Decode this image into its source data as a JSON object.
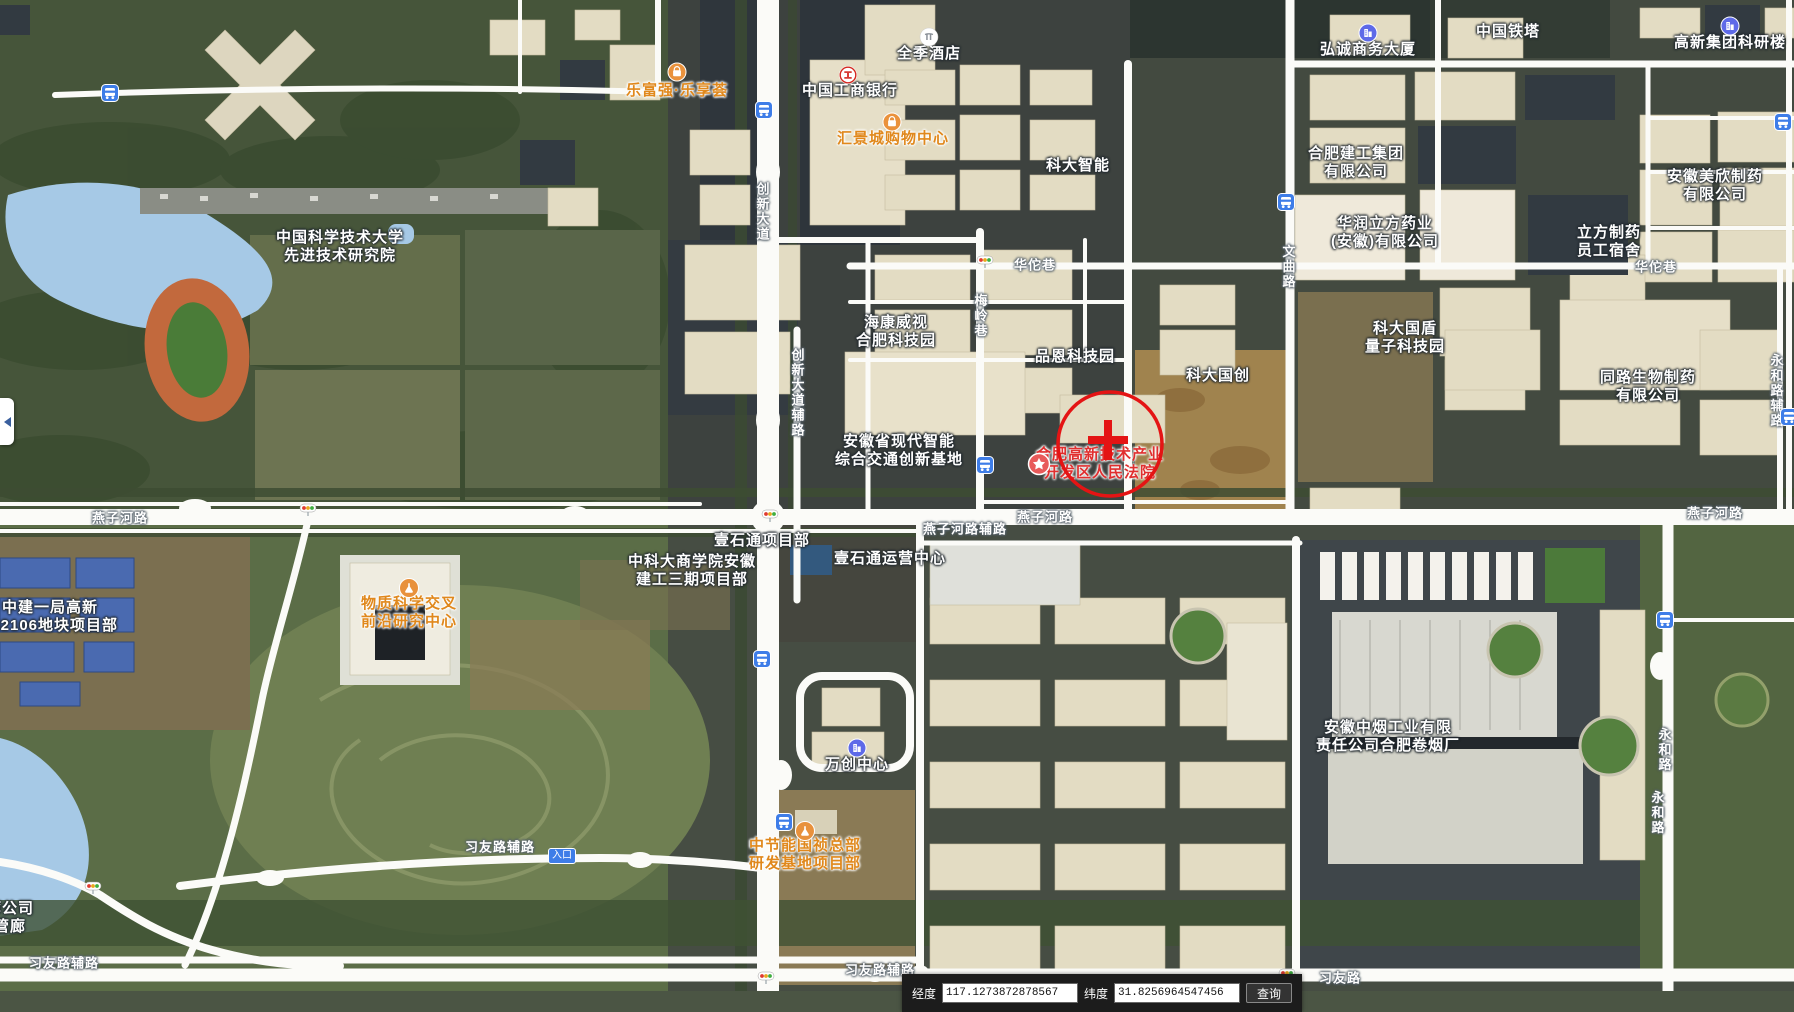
{
  "colors": {
    "accent_blue": "#3e7de8",
    "poi_orange": "#e0881c",
    "poi_red": "#e02f2f",
    "annotation_red": "#e41414",
    "road_white": "#fbfbf8",
    "water": "#a6c9e6"
  },
  "map": {
    "poi_labels": [
      {
        "name": "ustc-advanced-tech-institute",
        "lines": [
          "中国科学技术大学",
          "先进技术研究院"
        ],
        "x": 340,
        "y": 247,
        "color": "white"
      },
      {
        "name": "lefuqiang-lexianghui",
        "lines": [
          "乐富强·乐享荟"
        ],
        "x": 677,
        "y": 91,
        "color": "orange",
        "icon": "shopping-bag",
        "icon_pos": [
          677,
          72
        ]
      },
      {
        "name": "quanji-hotel",
        "lines": [
          "全季酒店"
        ],
        "x": 929,
        "y": 54,
        "color": "white",
        "icon": "hotel",
        "icon_pos": [
          929,
          37
        ]
      },
      {
        "name": "icbc-bank",
        "lines": [
          "中国工商银行"
        ],
        "x": 850,
        "y": 91,
        "color": "white",
        "icon": "bank",
        "icon_pos": [
          848,
          75
        ]
      },
      {
        "name": "huijingcheng-mall",
        "lines": [
          "汇景城购物中心"
        ],
        "x": 893,
        "y": 139,
        "color": "orange",
        "icon": "shopping-bag",
        "icon_pos": [
          892,
          122
        ]
      },
      {
        "name": "keda-intelligent",
        "lines": [
          "科大智能"
        ],
        "x": 1078,
        "y": 166,
        "color": "white"
      },
      {
        "name": "hikvision-hefei-tech-park",
        "lines": [
          "海康威视",
          "合肥科技园"
        ],
        "x": 896,
        "y": 332,
        "color": "white"
      },
      {
        "name": "pinen-tech-park",
        "lines": [
          "品恩科技园"
        ],
        "x": 1075,
        "y": 357,
        "color": "white"
      },
      {
        "name": "keda-guochuang",
        "lines": [
          "科大国创"
        ],
        "x": 1218,
        "y": 376,
        "color": "white"
      },
      {
        "name": "anhui-intelligent-transport-base",
        "lines": [
          "安徽省现代智能",
          "综合交通创新基地"
        ],
        "x": 899,
        "y": 451,
        "color": "white"
      },
      {
        "name": "hefei-hightech-court",
        "lines": [
          "合肥高新技术产业",
          "开发区人民法院"
        ],
        "x": 1100,
        "y": 464,
        "color": "red",
        "icon": "star",
        "icon_pos": [
          1039,
          464
        ]
      },
      {
        "name": "keda-guodun-quantum-park",
        "lines": [
          "科大国盾",
          "量子科技园"
        ],
        "x": 1405,
        "y": 338,
        "color": "white"
      },
      {
        "name": "tonglu-bio-pharma",
        "lines": [
          "同路生物制药",
          "有限公司"
        ],
        "x": 1648,
        "y": 387,
        "color": "white"
      },
      {
        "name": "hongcheng-business-tower",
        "lines": [
          "弘诚商务大厦"
        ],
        "x": 1368,
        "y": 50,
        "color": "white",
        "icon": "building",
        "icon_pos": [
          1368,
          33
        ]
      },
      {
        "name": "china-tower",
        "lines": [
          "中国铁塔"
        ],
        "x": 1508,
        "y": 32,
        "color": "white"
      },
      {
        "name": "gaoxin-group-research-building",
        "lines": [
          "高新集团科研楼"
        ],
        "x": 1730,
        "y": 43,
        "color": "white",
        "icon": "building",
        "icon_pos": [
          1730,
          26
        ]
      },
      {
        "name": "hefei-construction-group",
        "lines": [
          "合肥建工集团",
          "有限公司"
        ],
        "x": 1356,
        "y": 163,
        "color": "white"
      },
      {
        "name": "huarun-lifang-pharma",
        "lines": [
          "华润立方药业",
          "(安徽)有限公司"
        ],
        "x": 1385,
        "y": 233,
        "color": "white"
      },
      {
        "name": "lifang-pharma-dormitory",
        "lines": [
          "立方制药",
          "员工宿舍"
        ],
        "x": 1609,
        "y": 242,
        "color": "white"
      },
      {
        "name": "anhui-meixin-pharma",
        "lines": [
          "安徽美欣制药",
          "有限公司"
        ],
        "x": 1715,
        "y": 186,
        "color": "white"
      },
      {
        "name": "material-science-research-center",
        "lines": [
          "物质科学交叉",
          "前沿研究中心"
        ],
        "x": 409,
        "y": 613,
        "color": "orange",
        "icon": "flask",
        "icon_pos": [
          409,
          588
        ]
      },
      {
        "name": "zhongjian-yiju-project-dept",
        "lines": [
          "中建一局高新",
          "202106地块项目部"
        ],
        "x": 50,
        "y": 617,
        "color": "white"
      },
      {
        "name": "ustc-business-school-project",
        "lines": [
          "中科大商学院安徽",
          "建工三期项目部"
        ],
        "x": 692,
        "y": 571,
        "color": "white"
      },
      {
        "name": "yishitong-project-dept",
        "lines": [
          "壹石通项目部"
        ],
        "x": 762,
        "y": 541,
        "color": "white"
      },
      {
        "name": "yishitong-operation-center",
        "lines": [
          "壹石通运营中心"
        ],
        "x": 890,
        "y": 559,
        "color": "white"
      },
      {
        "name": "wanchuang-center",
        "lines": [
          "万创中心"
        ],
        "x": 857,
        "y": 765,
        "color": "white",
        "icon": "building",
        "icon_pos": [
          857,
          748
        ]
      },
      {
        "name": "cecep-guozhen-rd-base-project",
        "lines": [
          "中节能国祯总部",
          "研发基地项目部"
        ],
        "x": 805,
        "y": 855,
        "color": "orange",
        "icon": "flask",
        "icon_pos": [
          805,
          831
        ]
      },
      {
        "name": "anhui-tobacco-hefei-cigarette-factory",
        "lines": [
          "安徽中烟工业有限",
          "责任公司合肥卷烟厂"
        ],
        "x": 1388,
        "y": 737,
        "color": "white"
      },
      {
        "name": "pipe-gallery-company-partial",
        "lines": [
          "廊公司",
          "管廊"
        ],
        "x": 10,
        "y": 918,
        "color": "white"
      }
    ],
    "road_labels": [
      {
        "text": "燕子河路",
        "x": 120,
        "y": 517
      },
      {
        "text": "燕子河路辅路",
        "x": 965,
        "y": 528
      },
      {
        "text": "燕子河路",
        "x": 1045,
        "y": 516
      },
      {
        "text": "燕子河路",
        "x": 1715,
        "y": 512
      },
      {
        "text": "华佗巷",
        "x": 1035,
        "y": 264
      },
      {
        "text": "华佗巷",
        "x": 1656,
        "y": 266
      },
      {
        "text": "创新大道",
        "x": 762,
        "y": 212,
        "vertical": true
      },
      {
        "text": "创新大道辅路",
        "x": 797,
        "y": 393,
        "vertical": true
      },
      {
        "text": "梅岭巷",
        "x": 980,
        "y": 316,
        "vertical": true
      },
      {
        "text": "文曲路",
        "x": 1288,
        "y": 267,
        "vertical": true
      },
      {
        "text": "永和路辅路",
        "x": 1776,
        "y": 391,
        "vertical": true
      },
      {
        "text": "永和路",
        "x": 1664,
        "y": 750,
        "vertical": true
      },
      {
        "text": "永和路",
        "x": 1657,
        "y": 813,
        "vertical": true
      },
      {
        "text": "习友路辅路",
        "x": 500,
        "y": 846
      },
      {
        "text": "习友路辅路",
        "x": 64,
        "y": 962
      },
      {
        "text": "习友路辅路",
        "x": 880,
        "y": 969
      },
      {
        "text": "习友路",
        "x": 1340,
        "y": 977
      }
    ],
    "badges": [
      {
        "name": "entrance-badge",
        "text": "入口",
        "x": 562,
        "y": 856
      }
    ],
    "bus_stops": [
      [
        110,
        93
      ],
      [
        764,
        110
      ],
      [
        1286,
        202
      ],
      [
        1783,
        122
      ],
      [
        1789,
        417
      ],
      [
        985,
        465
      ],
      [
        762,
        659
      ],
      [
        784,
        822
      ],
      [
        1665,
        620
      ]
    ],
    "traffic_lights": [
      [
        985,
        262
      ],
      [
        308,
        510
      ],
      [
        770,
        516
      ],
      [
        93,
        888
      ],
      [
        766,
        978
      ],
      [
        1287,
        975
      ]
    ],
    "annotation": {
      "cx": 1110,
      "cy": 444,
      "r": 52,
      "cross_x": 1108,
      "cross_y": 440,
      "arm": 20,
      "color": "#e41414"
    }
  },
  "coordinate_bar": {
    "lng_label": "经度",
    "lng_value": "117.1273872878567",
    "lat_label": "纬度",
    "lat_value": "31.8256964547456",
    "search_button": "查询"
  }
}
